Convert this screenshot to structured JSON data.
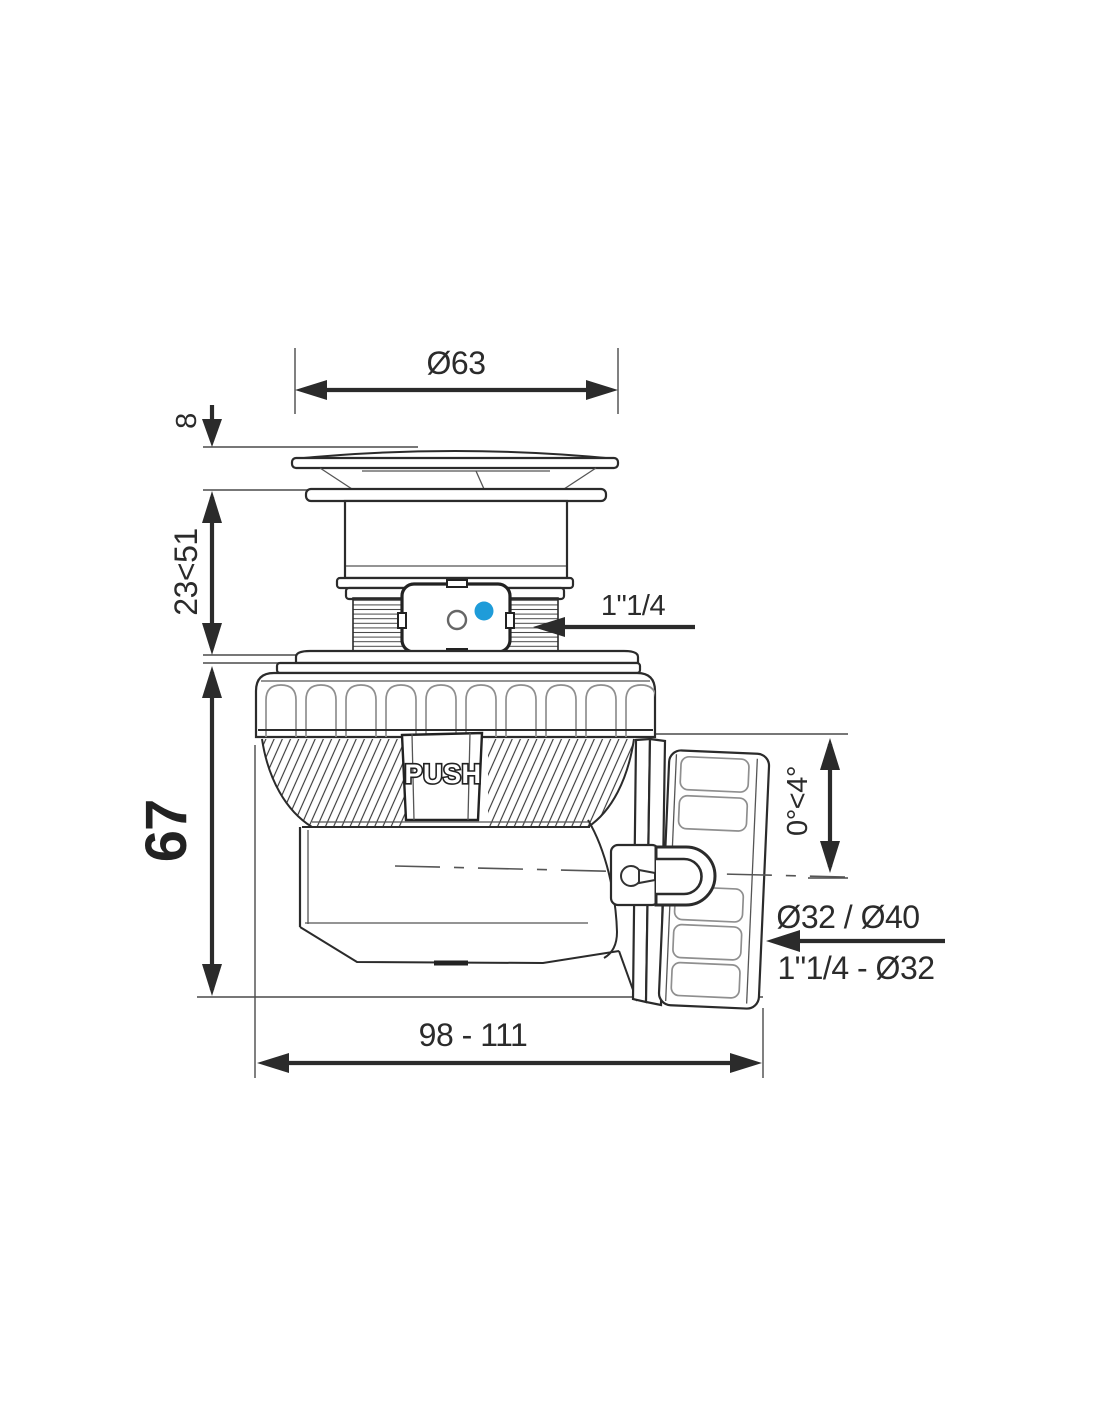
{
  "drawing": {
    "labels": {
      "cap_diameter": "Ø63",
      "cap_thickness": "8",
      "adjust_range": "23<51",
      "body_height": "67",
      "inlet_thread": "1\"1/4",
      "push": "PUSH",
      "outlet_angle": "0°<4°",
      "outlet_diameters": "Ø32 / Ø40",
      "outlet_thread": "1\"1/4 - Ø32",
      "overall_length": "98 - 111"
    },
    "colors": {
      "line": "#2b2b2b",
      "accent_blue": "#1f9cd9",
      "background": "#ffffff"
    }
  }
}
